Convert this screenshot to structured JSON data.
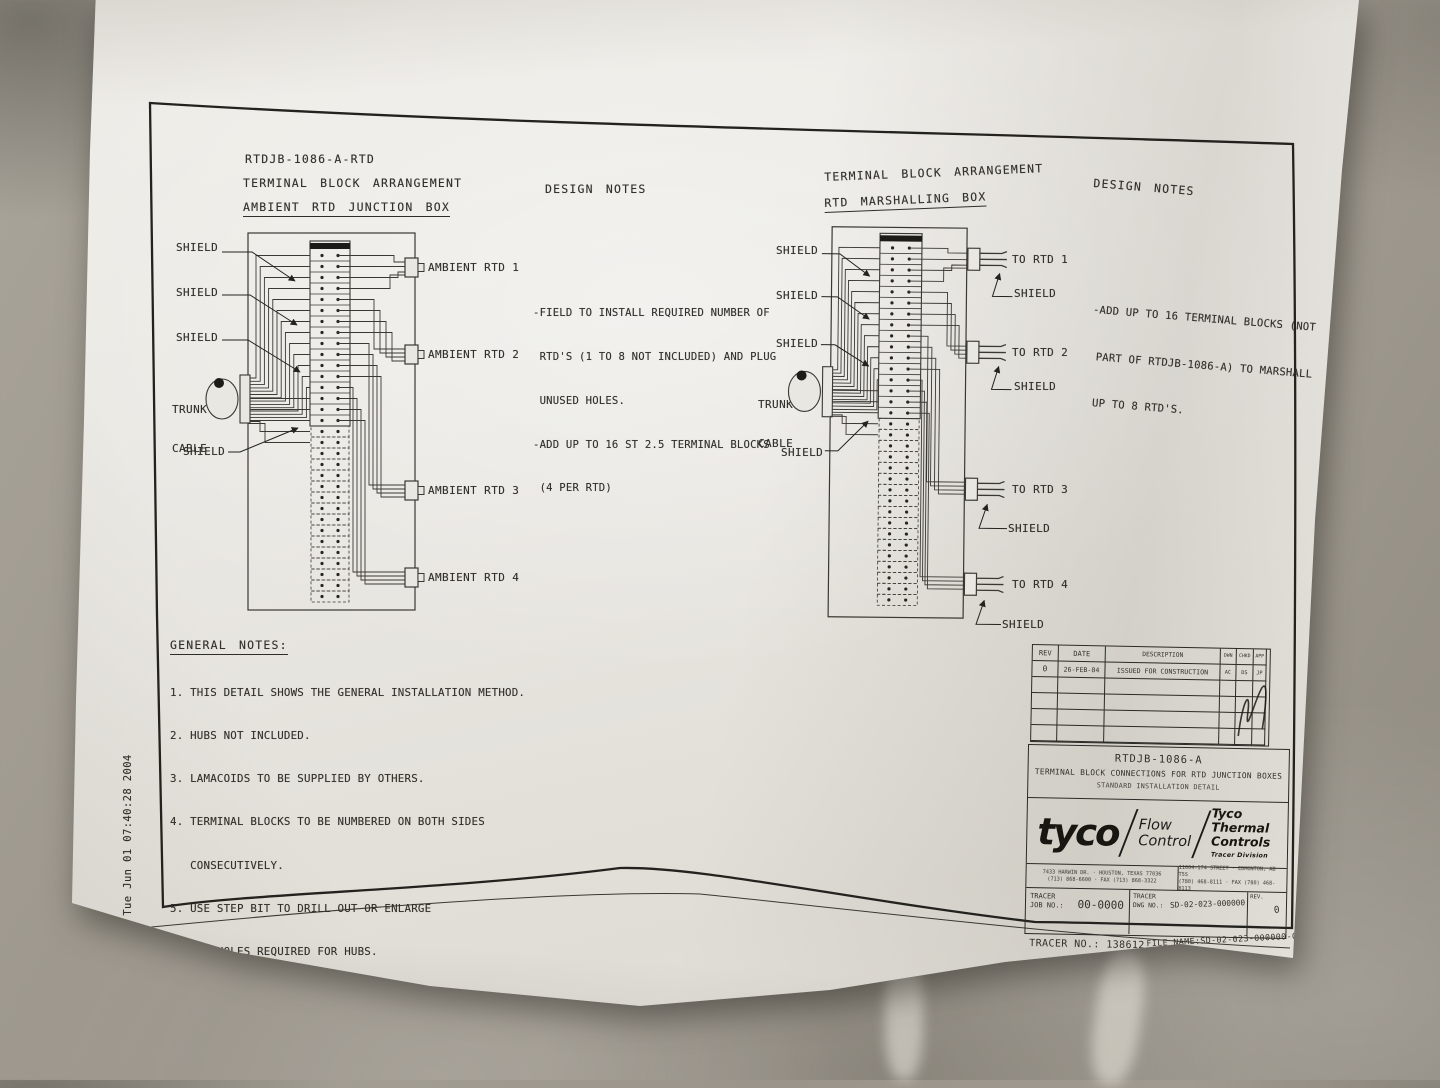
{
  "photo": {
    "stamp": "Tue Jun 01 07:40:28 2004"
  },
  "left_panel": {
    "part_number": "RTDJB-1086-A-RTD",
    "arrangement_title": "TERMINAL BLOCK ARRANGEMENT",
    "box_title": "AMBIENT RTD JUNCTION BOX",
    "design_notes_title": "DESIGN NOTES",
    "design_notes": [
      "-FIELD TO INSTALL REQUIRED NUMBER OF",
      " RTD'S (1 TO 8 NOT INCLUDED) AND PLUG",
      " UNUSED HOLES.",
      "-ADD UP TO 16 ST 2.5 TERMINAL BLOCKS",
      " (4 PER RTD)"
    ],
    "shield_label": "SHIELD",
    "trunk_label_1": "TRUNK",
    "trunk_label_2": "CABLE",
    "rtd_labels": [
      "AMBIENT RTD 1",
      "AMBIENT RTD 2",
      "AMBIENT RTD 3",
      "AMBIENT RTD 4"
    ]
  },
  "right_panel": {
    "arrangement_title": "TERMINAL BLOCK ARRANGEMENT",
    "box_title": "RTD MARSHALLING BOX",
    "design_notes_title": "DESIGN NOTES",
    "design_notes": [
      "-ADD UP TO 16 TERMINAL BLOCKS (NOT",
      " PART OF RTDJB-1086-A) TO MARSHALL",
      " UP TO 8 RTD'S."
    ],
    "shield_label": "SHIELD",
    "trunk_label_1": "TRUNK",
    "trunk_label_2": "CABLE",
    "rtd_labels": [
      "TO RTD 1",
      "TO RTD 2",
      "TO RTD 3",
      "TO RTD 4"
    ]
  },
  "general_notes": {
    "title": "GENERAL NOTES:",
    "items": [
      "1. THIS DETAIL SHOWS THE GENERAL INSTALLATION METHOD.",
      "2. HUBS NOT INCLUDED.",
      "3. LAMACOIDS TO BE SUPPLIED BY OTHERS.",
      "4. TERMINAL BLOCKS TO BE NUMBERED ON BOTH SIDES",
      "   CONSECUTIVELY.",
      "5. USE STEP BIT TO DRILL OUT OR ENLARGE",
      "   ANY HOLES REQUIRED FOR HUBS."
    ]
  },
  "title_block": {
    "revision_table": {
      "headers": [
        "REV",
        "DATE",
        "DESCRIPTION",
        "DWN",
        "CHKD",
        "APP"
      ],
      "row": {
        "rev": "0",
        "date": "26-FEB-04",
        "description": "ISSUED FOR CONSTRUCTION",
        "dwn": "AC",
        "chkd": "DS",
        "app": "JP"
      }
    },
    "drawing_number": "RTDJB-1086-A",
    "drawing_title": "TERMINAL BLOCK CONNECTIONS FOR RTD JUNCTION BOXES",
    "drawing_subtitle": "STANDARD INSTALLATION DETAIL",
    "brand": "tyco",
    "division_line1": "Flow",
    "division_line2": "Control",
    "company_line1": "Tyco Thermal",
    "company_line2": "Controls",
    "company_sub": "Tracer Division",
    "address_left_1": "7433 HARWIN DR.  ·  HOUSTON, TEXAS 77036",
    "address_left_2": "(713) 868-6600  ·  FAX (713) 868-3322",
    "address_right_1": "11004-174 STREET  ·  EDMONTON, AB T5S",
    "address_right_2": "(780) 468-8111  ·  FAX (780) 468-8113",
    "job_no_label": "TRACER",
    "job_no_label2": "JOB NO.:",
    "job_no_value": "00-0000",
    "dwg_no_label": "TRACER",
    "dwg_no_label2": "DWG NO.:",
    "dwg_no_value": "SD-02-023-000000",
    "rev_label": "REV.",
    "rev_value": "0",
    "tracer_no": "TRACER NO.: 138612",
    "file_name": "FILE NAME:SD-02-023-000000-0.DWG"
  }
}
